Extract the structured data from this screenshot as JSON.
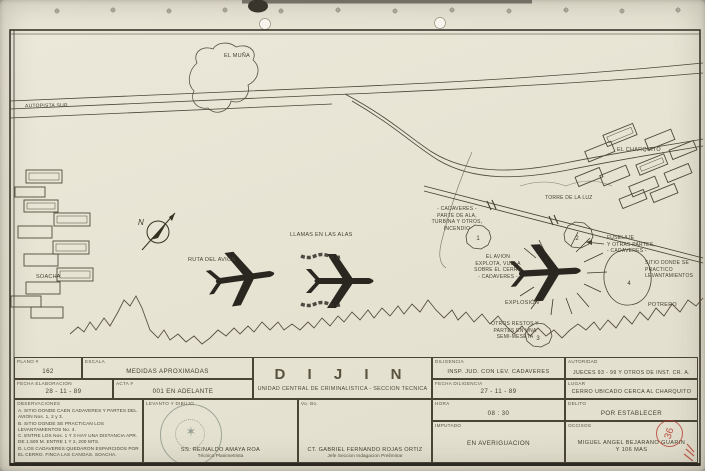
{
  "map": {
    "labels": {
      "el_muna": "EL MUÑA",
      "autopista_sur": "AUTOPISTA SUR",
      "soacha": "SOACHA",
      "ruta_del_avion": "RUTA DEL AVION",
      "llamas": "LLAMAS EN LAS ALAS",
      "torre_luz": "TORRE DE LA LUZ",
      "el_charquito": "EL CHARQUITO",
      "cadaveres_parte": "- CADAVERES -\nPARTE DE ALA,\nTURBINA Y OTROS,\nINCENDIO",
      "avion_explota": "EL AVION\nEXPLOTA, VUELA\nSOBRE EL CERRO\n- CADAVERES -",
      "explosion": "EXPLOSIÓN",
      "fuselaje": "FUSELAJE\nY OTRAS PARTES,\n- CADAVERES -",
      "sitio_levantamientos": "SITIO DONDE SE\nPRACTICO\nLEVANTAMIENTOS",
      "potrero": "POTRERO",
      "otros_restos": "OTROS RESTOS Y\nPARTES EN UNA\nSEMI-MESETA"
    },
    "compass": "N",
    "sites": {
      "s1": "1",
      "s2": "2",
      "s3": "3",
      "s4": "4"
    }
  },
  "title_block": {
    "plano": {
      "label": "PLANO #",
      "value": "162"
    },
    "escala": {
      "label": "ESCALA",
      "value": "MEDIDAS APROXIMADAS"
    },
    "fecha_elaboracion": {
      "label": "FECHA ELABORACION",
      "value": "28 - 11 - 89"
    },
    "acta": {
      "label": "ACTA #",
      "value": "001 EN ADELANTE"
    },
    "dijin": {
      "title": "D I J I N",
      "subtitle": "UNIDAD CENTRAL DE CRIMINALISTICA - SECCION TECNICA"
    },
    "diligencia": {
      "label": "DILIGENCIA",
      "value": "INSP. JUD. CON LEV. CADAVERES"
    },
    "autoridad": {
      "label": "AUTORIDAD",
      "value": "JUECES 93 - 99 Y OTROS DE INST. CR. A."
    },
    "fecha_diligencia": {
      "label": "FECHA DILIGENCIA",
      "value": "27 - 11 - 89"
    },
    "lugar": {
      "label": "LUGAR",
      "value": "CERRO UBICADO CERCA AL CHARQUITO"
    },
    "hora": {
      "label": "HORA",
      "value": "08 : 30"
    },
    "delito": {
      "label": "DELITO",
      "value": "POR ESTABLECER"
    },
    "imputado": {
      "label": "IMPUTADO",
      "value": "EN AVERIGUACION"
    },
    "occisos": {
      "label": "OCCISOS",
      "value": "MIGUEL ANGEL BEJARANO GUARIN\nY 106 MAS"
    },
    "observaciones": {
      "label": "OBSERVACIONES",
      "items": [
        "A. SITIO DONDE CAEN CADAVERES Y PARTES DEL AVION Nos. 1, 2 y 3.",
        "B. SITIO DONDE SE PRACTICAN LOS LEVANTAMIENTOS No. 4.",
        "C. ENTRE LOS Nos. 1 Y 3 HAY UNA DISTANCIA APR. DE 1.500 M. ENTRE 1 Y 2, 200 MTS.",
        "D. LOS CADAVERES QUEDARON ESPARCIDOS POR EL CERRO. FINCA LAS CANOAS. SOACHA."
      ]
    },
    "levanto": {
      "label": "LEVANTO Y DIBUJO",
      "name": "SS. REINALDO AMAYA ROA",
      "role": "Técnico Planimetrista"
    },
    "vobo": {
      "label": "Vo. Bo.",
      "name": "CT. GABRIEL FERNANDO ROJAS ORTIZ",
      "role": "Jefe Seccion Indagacion Preliminar"
    },
    "stamp_number": "36"
  },
  "colors": {
    "ink": "#4a4436",
    "dark_ink": "#2a2720",
    "red": "#b23a2e",
    "paper": "#e8e4d4"
  }
}
